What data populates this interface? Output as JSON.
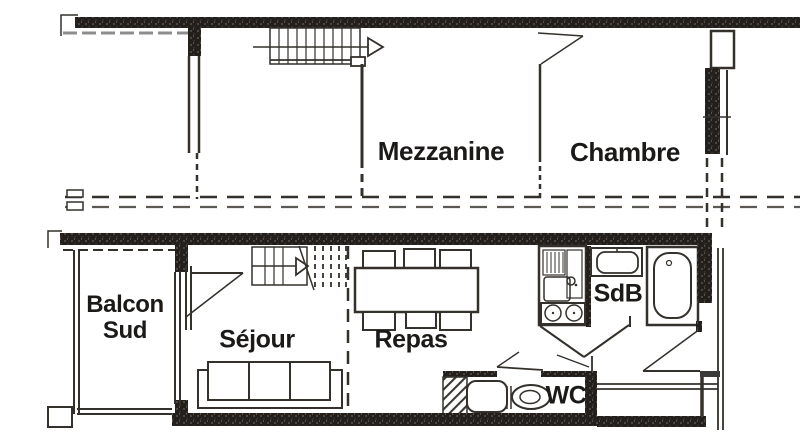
{
  "plan": {
    "upper_level": {
      "rooms": [
        {
          "id": "mezzanine",
          "label": "Mezzanine"
        },
        {
          "id": "chambre",
          "label": "Chambre"
        }
      ]
    },
    "lower_level": {
      "rooms": [
        {
          "id": "balcon-sud",
          "label": "Balcon Sud"
        },
        {
          "id": "sejour",
          "label": "Séjour"
        },
        {
          "id": "repas",
          "label": "Repas"
        },
        {
          "id": "sdb",
          "label": "SdB"
        },
        {
          "id": "wc",
          "label": "WC"
        }
      ]
    }
  },
  "labels": {
    "mezzanine": "Mezzanine",
    "chambre": "Chambre",
    "balcon_line1": "Balcon",
    "balcon_line2": "Sud",
    "sejour": "Séjour",
    "repas": "Repas",
    "sdb": "SdB",
    "wc": "WC"
  },
  "colors": {
    "background": "#ffffff",
    "wall": "#221f1c",
    "line": "#34302b"
  }
}
